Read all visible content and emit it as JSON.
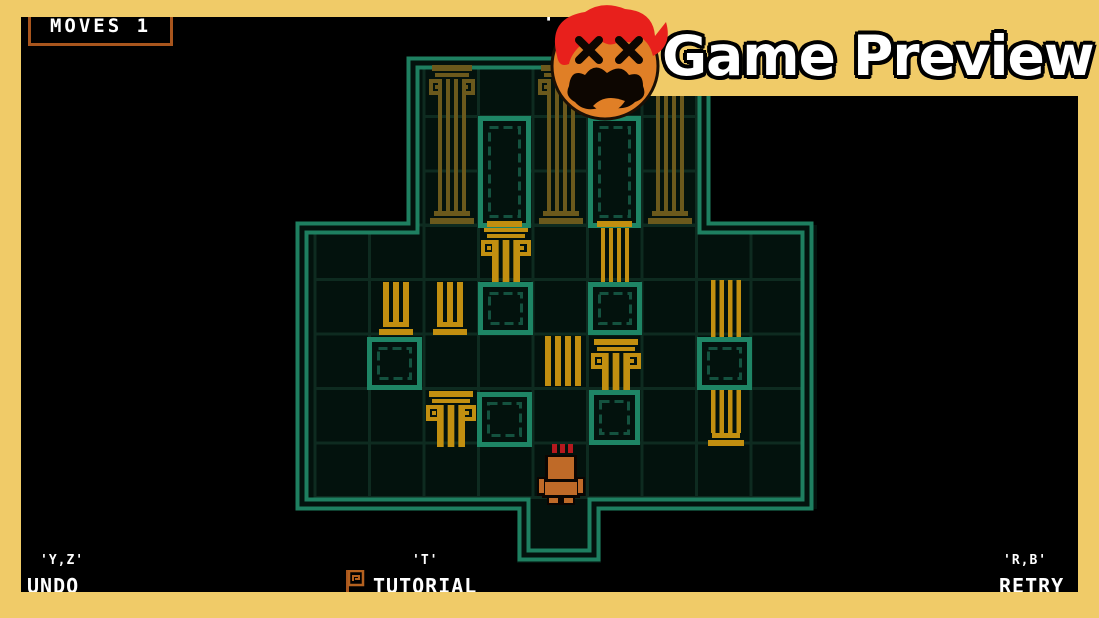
{
  "banner": {
    "label": "Game Preview",
    "bg": "#f0cb68",
    "text_color": "#ffffff",
    "outline_color": "#000000",
    "logo": {
      "name": "ko-face-logo",
      "colors": {
        "hair": "#e8201c",
        "face": "#e07f26",
        "features": "#0d0601"
      }
    }
  },
  "frame": {
    "color": "#f0cb68"
  },
  "hud": {
    "moves_label": "MOVES 1",
    "moves_box_color": "#a8551d",
    "top_hint": "'",
    "undo": {
      "key": "'Y,Z'",
      "label": "UNDO"
    },
    "tutorial": {
      "key": "'T'",
      "label": "TUTORIAL",
      "icon": "greek-flag-icon",
      "icon_color": "#b4611f"
    },
    "retry": {
      "key": "'R,B'",
      "label": "RETRY"
    }
  },
  "board": {
    "colors": {
      "wall": "#1e7f60",
      "wall_gap": "#03120d",
      "grid": "#0e2b20",
      "cell_bg": "#03120d",
      "socket": "#1e8565",
      "socket_inner": "#14523f",
      "pillar": "#c28f10",
      "pillar_dim": "#6b591c",
      "player": "#bf6a28",
      "flame": "#b5191e",
      "outline": "#0a0502"
    },
    "regions": [
      {
        "x": 296,
        "y": 225,
        "w": 521,
        "h": 284
      },
      {
        "x": 407,
        "y": 57,
        "w": 303,
        "h": 171
      },
      {
        "x": 517,
        "y": 503,
        "w": 84,
        "h": 60
      }
    ],
    "grids": [
      {
        "x0": 315,
        "y0": 225,
        "cols": 9,
        "rows": 5,
        "cell": 54.5
      },
      {
        "x0": 424,
        "y0": 62,
        "cols": 5,
        "rows": 3,
        "cell": 54.5
      }
    ],
    "wall_path": "M302 228 H413 V63 H704 V228 H807 V504 H594 V555 H524 V504 H302 Z",
    "pillars": [
      {
        "x": 428,
        "y": 64,
        "w": 48,
        "h": 160,
        "sw": 28,
        "bars": 4,
        "capital": true,
        "base": true,
        "dim": true
      },
      {
        "x": 537,
        "y": 64,
        "w": 48,
        "h": 160,
        "sw": 28,
        "bars": 4,
        "capital": true,
        "base": true,
        "dim": true
      },
      {
        "x": 646,
        "y": 64,
        "w": 48,
        "h": 160,
        "sw": 28,
        "bars": 4,
        "capital": true,
        "base": true,
        "dim": true
      },
      {
        "x": 480,
        "y": 225,
        "w": 52,
        "h": 57,
        "sw": 28,
        "bars": 3,
        "capital": true,
        "base": false
      },
      {
        "x": 601,
        "y": 225,
        "w": 28,
        "h": 57,
        "sw": 28,
        "bars": 4,
        "capital": false,
        "base": false
      },
      {
        "x": 377,
        "y": 282,
        "w": 38,
        "h": 53,
        "sw": 26,
        "bars": 3,
        "capital": false,
        "base": true
      },
      {
        "x": 431,
        "y": 282,
        "w": 38,
        "h": 53,
        "sw": 26,
        "bars": 3,
        "capital": false,
        "base": true
      },
      {
        "x": 545,
        "y": 336,
        "w": 36,
        "h": 50,
        "sw": 36,
        "bars": 4,
        "capital": false,
        "base": false
      },
      {
        "x": 590,
        "y": 338,
        "w": 52,
        "h": 55,
        "sw": 28,
        "bars": 3,
        "capital": true,
        "base": false
      },
      {
        "x": 706,
        "y": 280,
        "w": 40,
        "h": 166,
        "sw": 30,
        "bars": 4,
        "capital": false,
        "base": true
      },
      {
        "x": 425,
        "y": 390,
        "w": 52,
        "h": 57,
        "sw": 28,
        "bars": 3,
        "capital": true,
        "base": false
      }
    ],
    "door_frames": [
      {
        "x": 478,
        "y": 116,
        "w": 53,
        "h": 112,
        "threshold": true
      },
      {
        "x": 588,
        "y": 116,
        "w": 53,
        "h": 112,
        "threshold": true
      }
    ],
    "sockets": [
      {
        "x": 478,
        "y": 282,
        "w": 55,
        "h": 53
      },
      {
        "x": 588,
        "y": 282,
        "w": 54,
        "h": 53
      },
      {
        "x": 367,
        "y": 337,
        "w": 55,
        "h": 53
      },
      {
        "x": 697,
        "y": 337,
        "w": 55,
        "h": 53
      },
      {
        "x": 477,
        "y": 392,
        "w": 55,
        "h": 55
      },
      {
        "x": 589,
        "y": 390,
        "w": 51,
        "h": 55
      }
    ],
    "player": {
      "x": 537,
      "y": 444,
      "w": 48,
      "h": 59
    }
  }
}
